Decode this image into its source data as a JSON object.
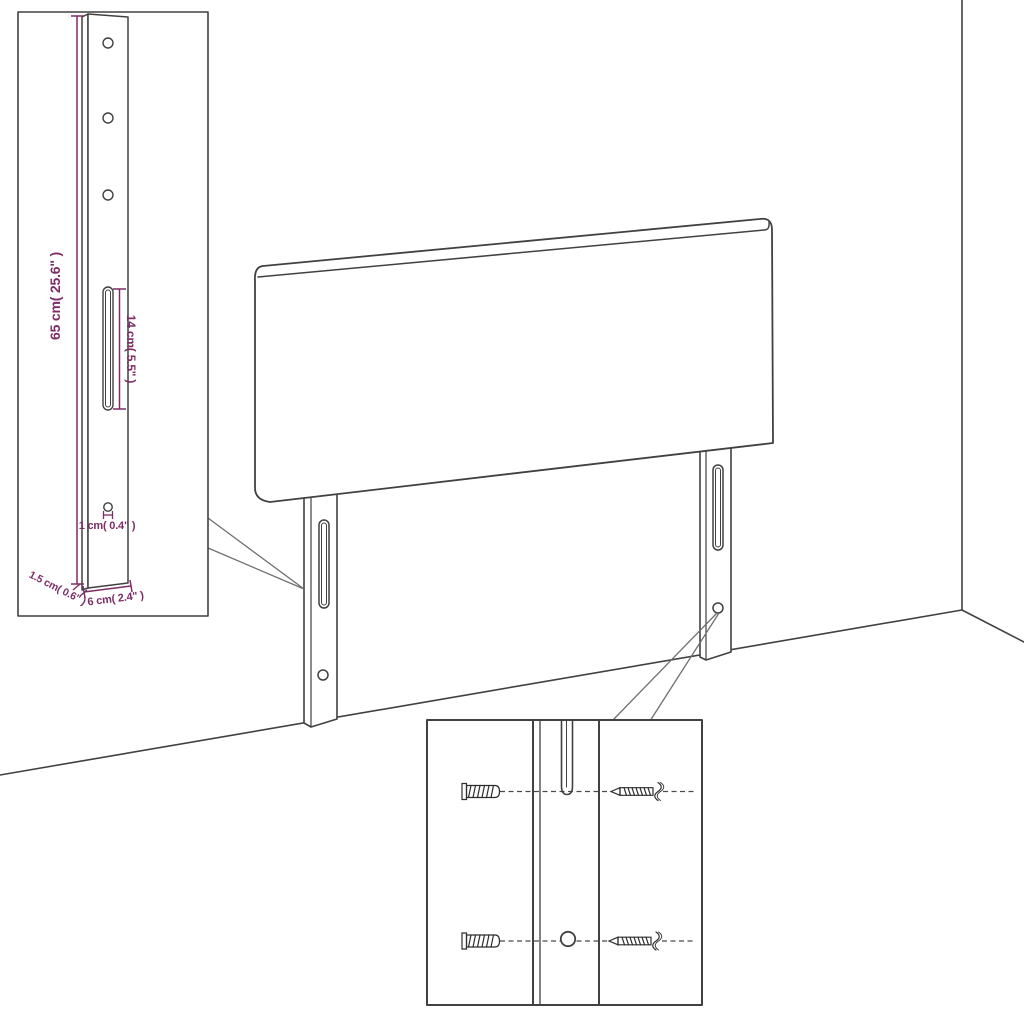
{
  "diagram": {
    "title": "headboard-mounting-dimension-diagram",
    "colors": {
      "background": "#ffffff",
      "linework": "#414141",
      "dimension": "#7d2c66",
      "callout": "#707070"
    },
    "bracket_inset": {
      "height_label": "65 cm( 25.6\" )",
      "slot_length_label": "14 cm( 5.5\" )",
      "hole_diameter_label": "1 cm( 0.4\" )",
      "width_label": "6 cm( 2.4\" )",
      "depth_label": "1.5 cm( 0.6\" )"
    }
  }
}
